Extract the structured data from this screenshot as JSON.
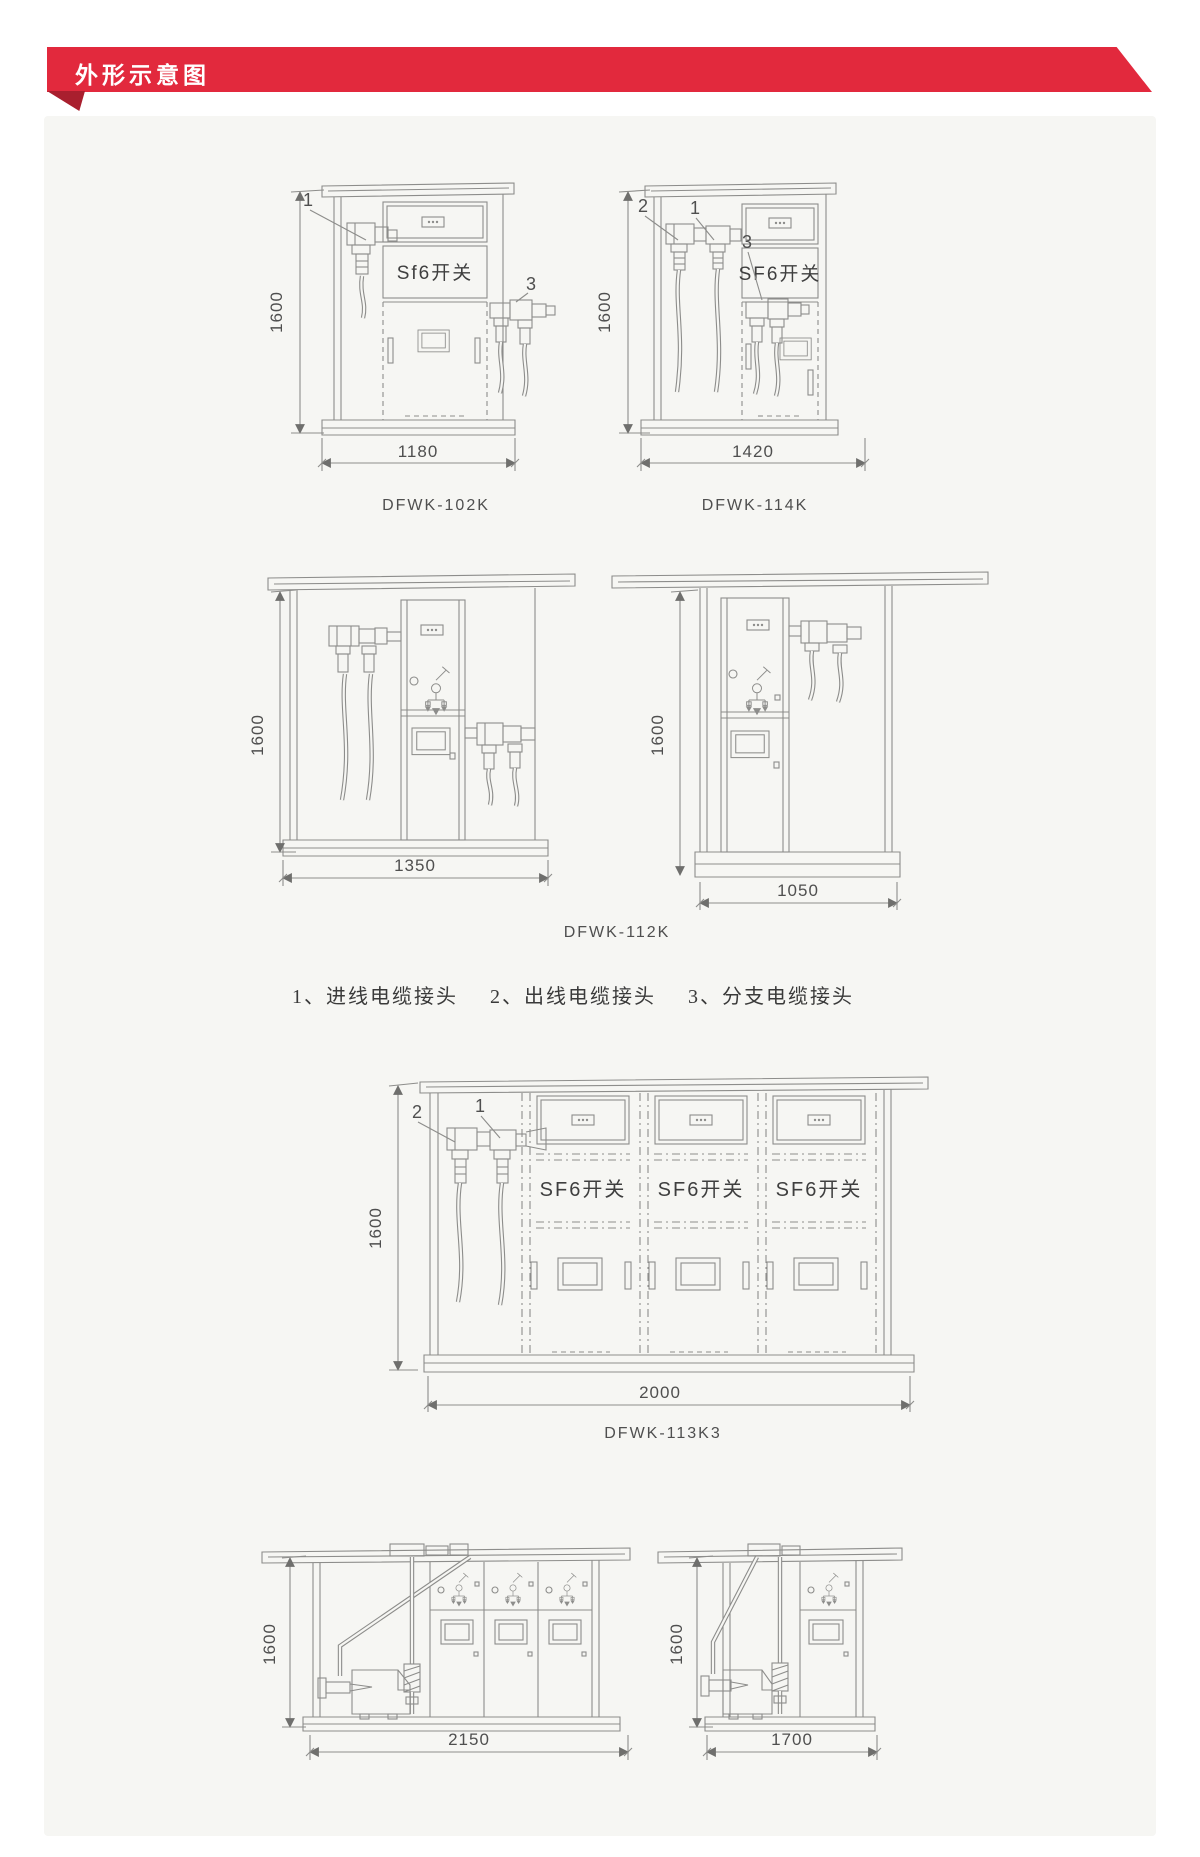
{
  "header": {
    "title": "外形示意图"
  },
  "shared": {
    "height_dim": "1600"
  },
  "callouts": {
    "c1": "1",
    "c2": "2",
    "c3": "3"
  },
  "drawings": {
    "dfwk102k": {
      "caption": "DFWK-102K",
      "width_dim": "1180",
      "switch_label": "Sf6开关"
    },
    "dfwk114k": {
      "caption": "DFWK-114K",
      "width_dim": "1420",
      "switch_label": "SF6开关"
    },
    "dfwk112k": {
      "caption": "DFWK-112K",
      "front_width_dim": "1350",
      "side_width_dim": "1050"
    },
    "dfwk113k3": {
      "caption": "DFWK-113K3",
      "width_dim": "2000",
      "switch_label": "SF6开关"
    },
    "view2150": {
      "width_dim": "2150"
    },
    "view1700": {
      "width_dim": "1700"
    }
  },
  "legend": {
    "item1": "1、进线电缆接头",
    "item2": "2、出线电缆接头",
    "item3": "3、分支电缆接头"
  },
  "colors": {
    "banner_red": "#e2293d",
    "banner_fold": "#a91f2e",
    "line_gray": "#8d8d8b"
  }
}
